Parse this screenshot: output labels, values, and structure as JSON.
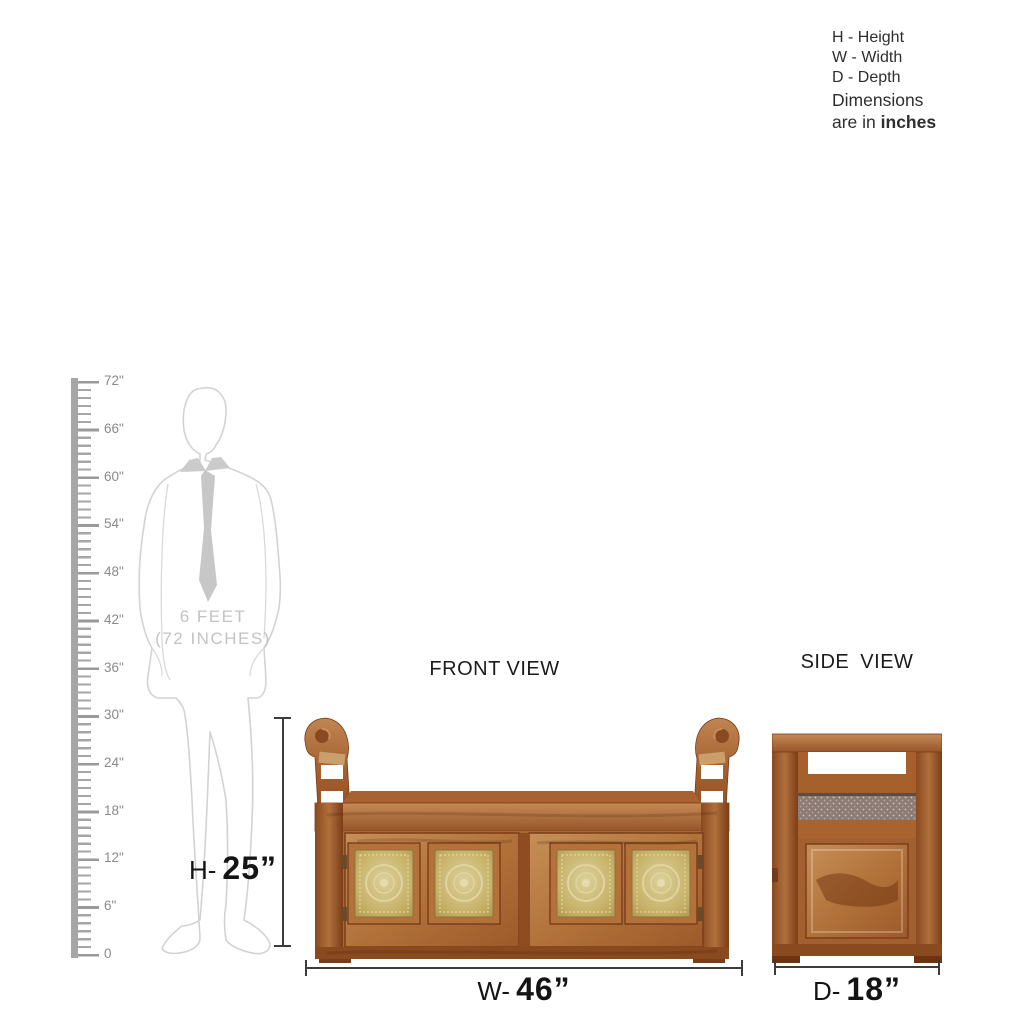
{
  "legend": {
    "items": [
      "H - Height",
      "W - Width",
      "D - Depth"
    ],
    "note_line1": "Dimensions",
    "note_line2_prefix": "are in ",
    "note_line2_bold": "inches"
  },
  "ruler": {
    "labels": [
      "72\"",
      "66\"",
      "60\"",
      "54\"",
      "48\"",
      "42\"",
      "36\"",
      "30\"",
      "24\"",
      "18\"",
      "12\"",
      "6\"",
      "0"
    ]
  },
  "silhouette": {
    "line1": "6 FEET",
    "line2": "(72 INCHES)"
  },
  "views": {
    "front": {
      "title": "FRONT VIEW"
    },
    "side": {
      "title": "SIDE VIEW"
    }
  },
  "dimensions": {
    "height": {
      "prefix": "H-",
      "value": "25”"
    },
    "width": {
      "prefix": "W-",
      "value": "46”"
    },
    "depth": {
      "prefix": "D-",
      "value": "18”"
    }
  },
  "colors": {
    "wood_mid": "#a9682f",
    "wood_light": "#c68f58",
    "wood_dark": "#7c3d18",
    "brass": "#c9b26a",
    "ruler_gray": "#a6a6a6",
    "silhouette_gray": "#d3d3d3",
    "dimension_line": "#3c3c3c"
  }
}
